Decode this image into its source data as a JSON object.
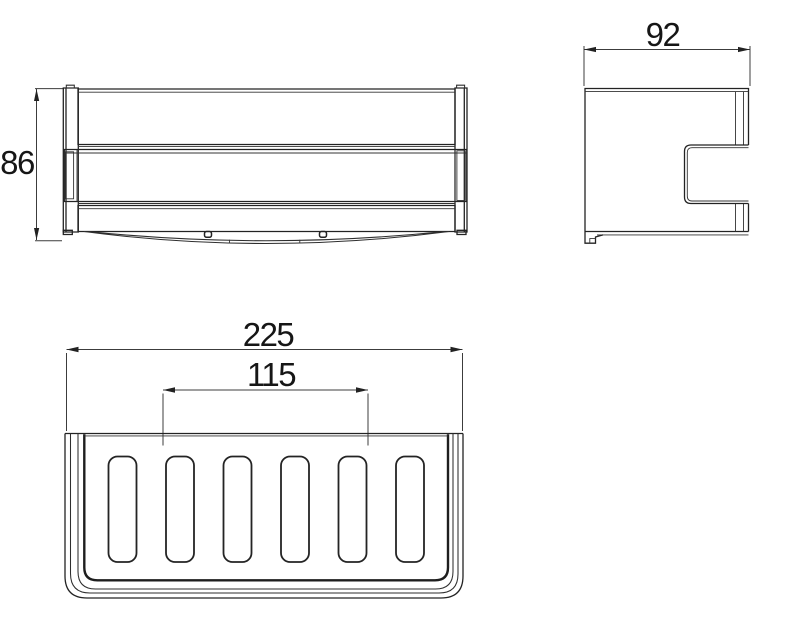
{
  "drawing": {
    "kind": "technical-orthographic-drawing",
    "subject": "wall-mounted basket / shower caddy",
    "colors": {
      "line": "#222222",
      "dimension_line": "#3c3c3c",
      "text": "#161616",
      "background": "#ffffff"
    },
    "views": {
      "front": {
        "label": "front view",
        "height_dim": "86"
      },
      "side": {
        "label": "side view",
        "width_dim": "92"
      },
      "bottom": {
        "label": "bottom view",
        "outer_width_dim": "225",
        "mount_spacing_dim": "115",
        "slot_count": 6
      }
    },
    "dimensions": [
      {
        "value": "86",
        "view": "front",
        "orientation": "vertical"
      },
      {
        "value": "92",
        "view": "side",
        "orientation": "horizontal"
      },
      {
        "value": "225",
        "view": "bottom",
        "orientation": "horizontal"
      },
      {
        "value": "115",
        "view": "bottom",
        "orientation": "horizontal"
      }
    ]
  }
}
